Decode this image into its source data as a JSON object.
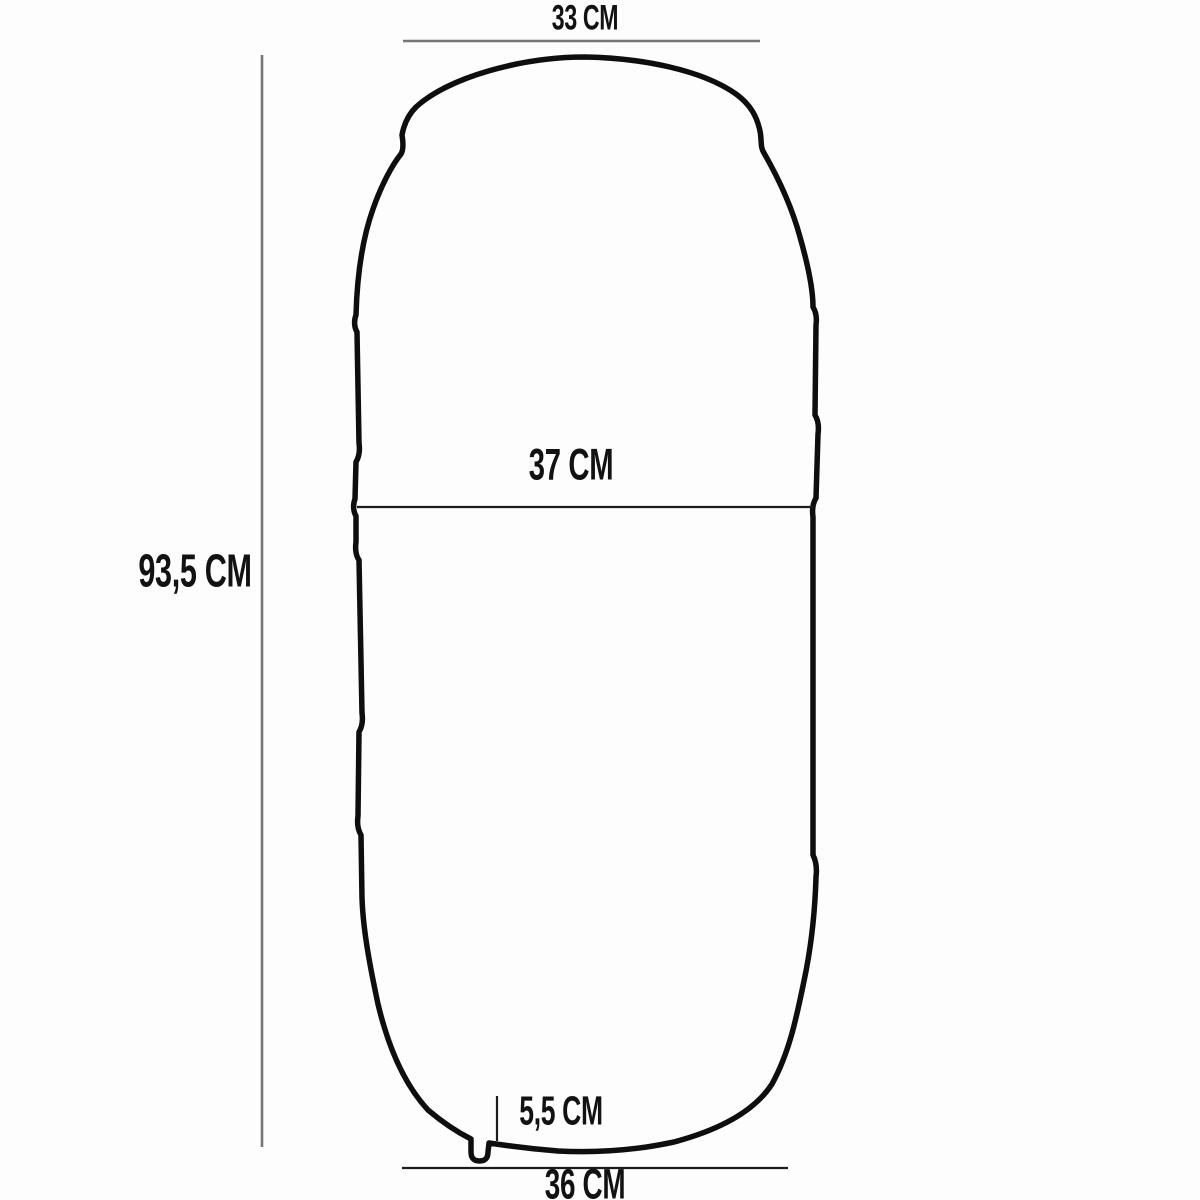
{
  "labels": {
    "top_width": "33 CM",
    "middle_width": "37 CM",
    "height": "93,5 CM",
    "valve_height": "5,5 CM",
    "bottom_width": "36 CM"
  },
  "colors": {
    "outline": "#0e0e0e",
    "dim_line_gray": "#767676",
    "dim_line_dark": "#1c1c1c",
    "background": "#fdfdfd",
    "label_text": "#121212"
  }
}
